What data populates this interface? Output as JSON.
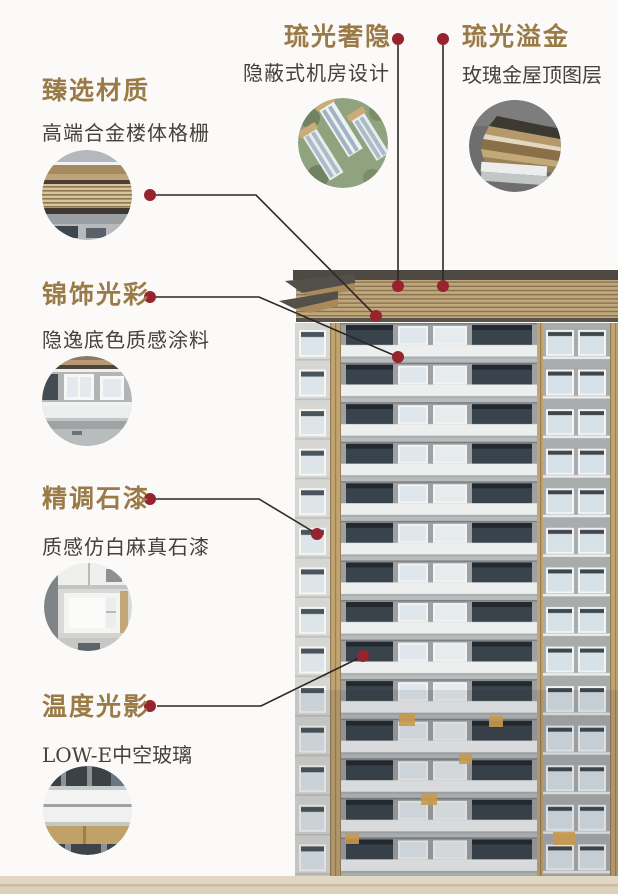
{
  "page": {
    "background_color": "#fbfaf8",
    "accent_gold": "#9a7b47",
    "body_text_color": "#45403a",
    "dot_color": "#96232e",
    "line_color": "#2b2826",
    "ground_color": "#e2d7c2"
  },
  "callouts": [
    {
      "id": "materials",
      "title": "臻选材质",
      "subtitle": "高端合金楼体格栅",
      "thumbnail": "alloy-grille-photo"
    },
    {
      "id": "hidden-room",
      "title": "琉光奢隐",
      "subtitle": "隐蔽式机房设计",
      "thumbnail": "aerial-towers-photo"
    },
    {
      "id": "gold-roof",
      "title": "琉光溢金",
      "subtitle": "玫瑰金屋顶图层",
      "thumbnail": "rose-gold-roof-photo"
    },
    {
      "id": "coating",
      "title": "锦饰光彩",
      "subtitle": "隐逸底色质感涂料",
      "thumbnail": "facade-coating-photo"
    },
    {
      "id": "stone-paint",
      "title": "精调石漆",
      "subtitle": "质感仿白麻真石漆",
      "thumbnail": "stone-paint-window-photo"
    },
    {
      "id": "low-e-glass",
      "title": "温度光影",
      "subtitle": "LOW-E中空玻璃",
      "thumbnail": "low-e-glass-photo"
    }
  ]
}
